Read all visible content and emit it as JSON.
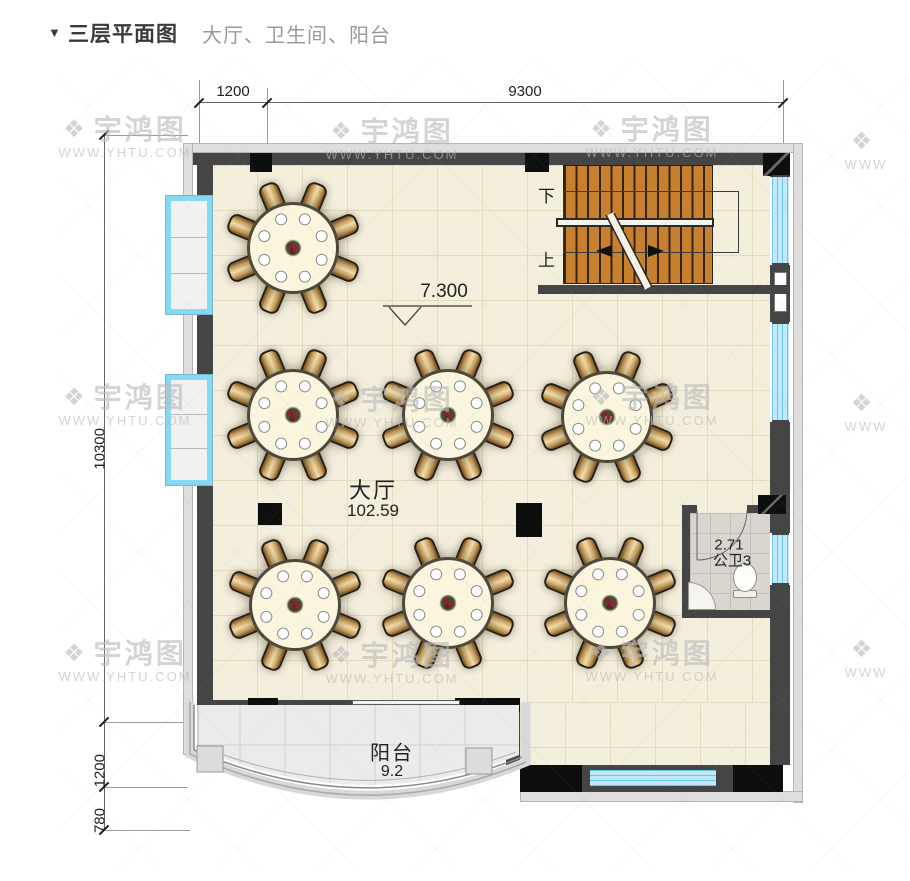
{
  "page": {
    "marker": "▼",
    "title": "三层平面图",
    "subtitle": "大厅、卫生间、阳台"
  },
  "dims": {
    "top": [
      "1200",
      "9300"
    ],
    "left": [
      "10300",
      "1200",
      "780"
    ]
  },
  "labels": {
    "stairs_down": "下",
    "stairs_up": "上",
    "level": "7.300",
    "hall_name": "大厅",
    "hall_area": "102.59",
    "bath_area": "2.71",
    "bath_name": "公卫3",
    "balcony_name": "阳台",
    "balcony_area": "9.2"
  },
  "watermark": {
    "brand": "宇鸿图",
    "url": "WWW.YHTU.COM",
    "short": "WWW",
    "logo_icon": "❖",
    "spots": [
      {
        "x": 125,
        "y": 138,
        "type": "full"
      },
      {
        "x": 392,
        "y": 140,
        "type": "full"
      },
      {
        "x": 652,
        "y": 138,
        "type": "full"
      },
      {
        "x": 125,
        "y": 406,
        "type": "full"
      },
      {
        "x": 392,
        "y": 408,
        "type": "full"
      },
      {
        "x": 652,
        "y": 406,
        "type": "full"
      },
      {
        "x": 125,
        "y": 662,
        "type": "full"
      },
      {
        "x": 392,
        "y": 664,
        "type": "full"
      },
      {
        "x": 652,
        "y": 662,
        "type": "full"
      },
      {
        "x": 866,
        "y": 150,
        "type": "side"
      },
      {
        "x": 866,
        "y": 412,
        "type": "side"
      },
      {
        "x": 866,
        "y": 658,
        "type": "side"
      }
    ]
  },
  "colors": {
    "wall": "#454545",
    "column": "#0e0e0e",
    "window_blue": "#bfe9f8",
    "stair_wood": "#c8802e",
    "hall_floor": "#f4eedd",
    "balcony_floor": "#ebebeb",
    "bath_floor": "#d9d5cf",
    "text": "#222222"
  },
  "floorplan": {
    "seats_per_table": 8,
    "stair_tread_count": 13,
    "tables": [
      {
        "x": 293,
        "y": 248
      },
      {
        "x": 293,
        "y": 415
      },
      {
        "x": 448,
        "y": 415
      },
      {
        "x": 607,
        "y": 417
      },
      {
        "x": 295,
        "y": 605
      },
      {
        "x": 448,
        "y": 603
      },
      {
        "x": 610,
        "y": 603
      }
    ]
  }
}
